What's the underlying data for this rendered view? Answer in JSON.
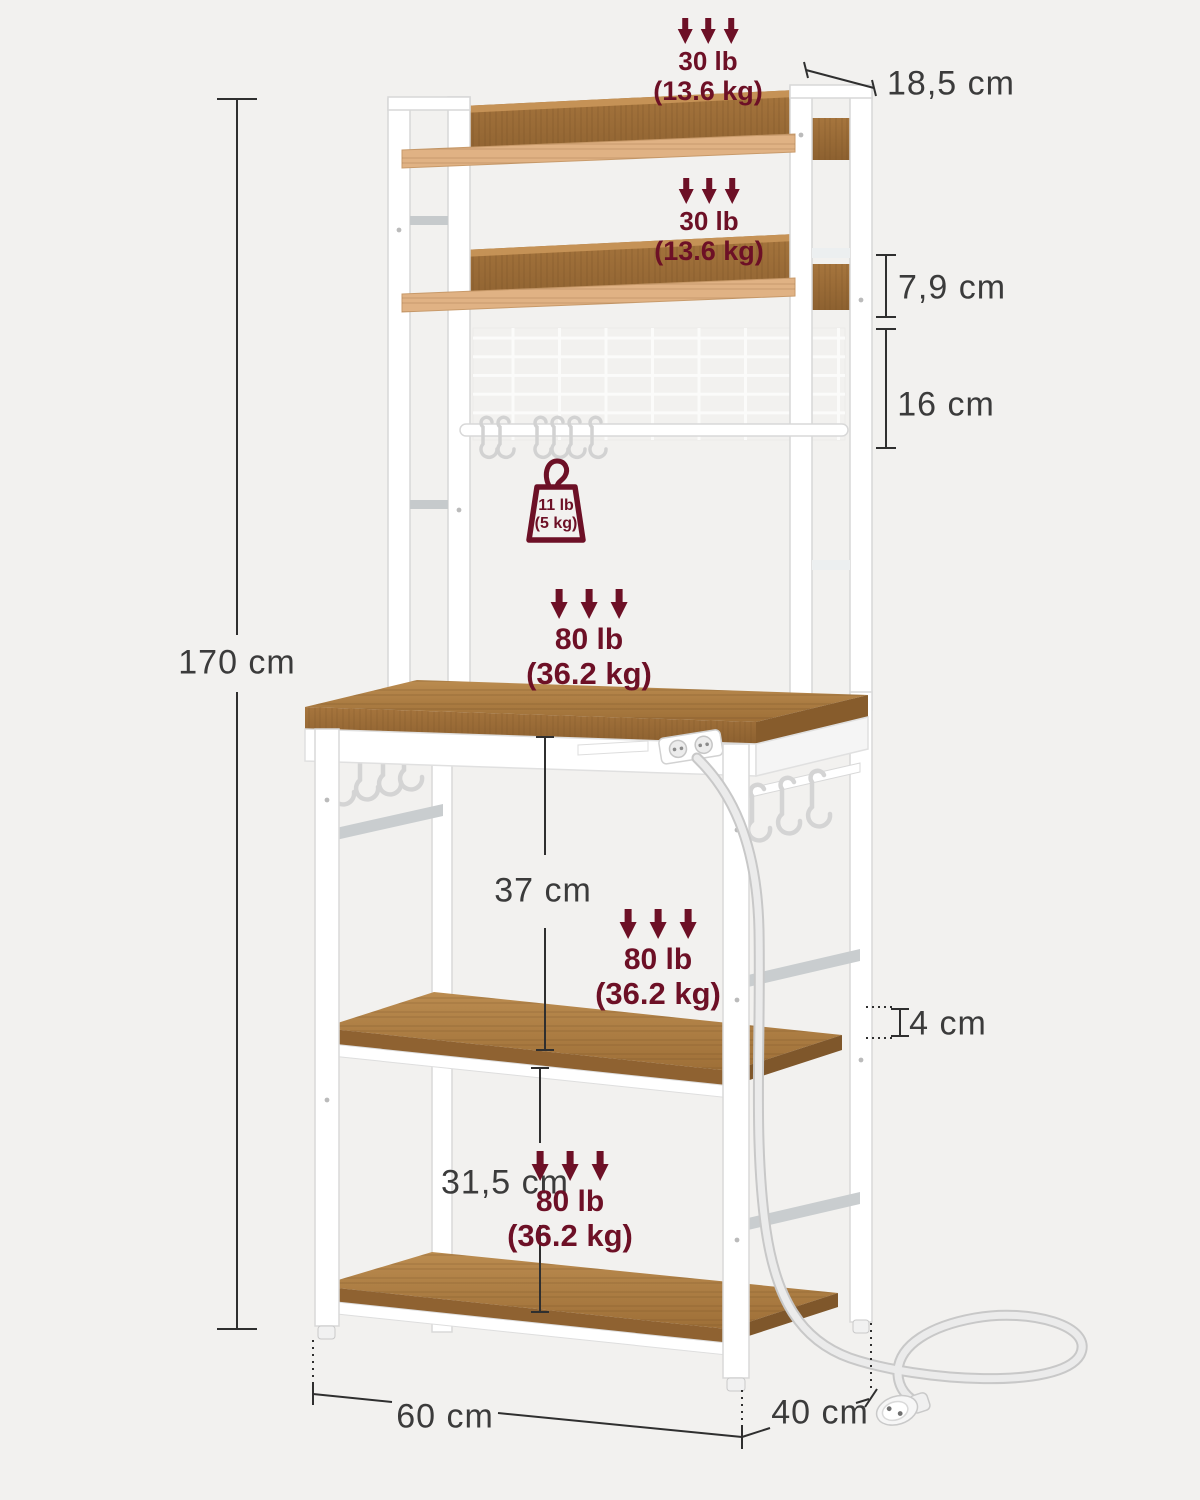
{
  "title": "Bakers rack dimension diagram",
  "capacities": {
    "top_shelf": {
      "lb": "30 lb",
      "kg": "(13.6 kg)"
    },
    "second_shelf": {
      "lb": "30 lb",
      "kg": "(13.6 kg)"
    },
    "counter": {
      "lb": "80 lb",
      "kg": "(36.2 kg)"
    },
    "middle_shelf": {
      "lb": "80 lb",
      "kg": "(36.2 kg)"
    },
    "bottom_shelf": {
      "lb": "80 lb",
      "kg": "(36.2 kg)"
    },
    "hook_rail": {
      "lb": "11 lb",
      "kg": "(5 kg)"
    }
  },
  "dimensions": {
    "total_height": "170 cm",
    "hutch_depth": "18,5 cm",
    "shelf_spacing_top": "7,9 cm",
    "grid_panel_height": "16 cm",
    "counter_clearance": "37 cm",
    "shelf_thickness": "4 cm",
    "lower_clearance": "31,5 cm",
    "width": "60 cm",
    "depth": "40 cm"
  },
  "colors": {
    "background": "#f2f1ef",
    "accent_burgundy": "#6d1026",
    "dimension_text": "#3b3b3b",
    "wood": "#a9783f",
    "light_wood_rail": "#e0b284",
    "metal_white": "#ffffff"
  }
}
